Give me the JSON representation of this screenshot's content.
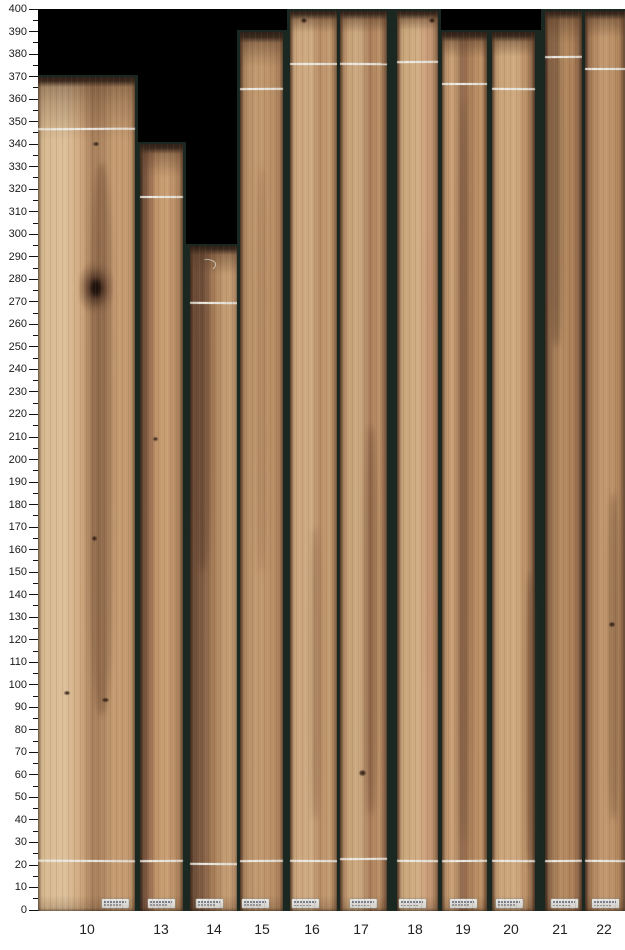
{
  "page": {
    "background": "#ffffff",
    "plot_background": "#000000",
    "gap_color": "#1b2822",
    "chalk_color": "#e9e7df",
    "tick_color": "#111111"
  },
  "chart_data": {
    "type": "bar",
    "title": "",
    "xlabel": "",
    "ylabel": "",
    "categories": [
      "10",
      "13",
      "14",
      "15",
      "16",
      "17",
      "18",
      "19",
      "20",
      "21",
      "22"
    ],
    "values": [
      370,
      340,
      295,
      390,
      400,
      400,
      400,
      390,
      390,
      400,
      400
    ],
    "cropped_at_ymax": [
      "16",
      "17",
      "18",
      "21",
      "22"
    ],
    "top_chalk_lines": [
      347,
      317,
      270,
      365,
      376,
      376,
      377,
      367,
      365,
      379,
      374
    ],
    "bottom_chalk_lines": [
      22,
      22,
      21,
      22,
      22,
      23,
      22,
      22,
      22,
      22,
      22
    ],
    "ylim": [
      0,
      400
    ],
    "y_major_step": 10,
    "y_minor_step": 5,
    "grid": false,
    "legend": false,
    "y_tick_labels": [
      400,
      390,
      380,
      370,
      360,
      350,
      340,
      330,
      320,
      310,
      300,
      290,
      280,
      270,
      260,
      250,
      240,
      230,
      220,
      210,
      200,
      190,
      180,
      170,
      160,
      150,
      140,
      130,
      120,
      110,
      100,
      90,
      80,
      70,
      60,
      50,
      40,
      30,
      20,
      10,
      0
    ]
  },
  "boards": [
    {
      "id": "10",
      "x": 38,
      "w": 97,
      "gl": 0,
      "gr": 3,
      "cx": 87,
      "top": 370,
      "lt": 347,
      "lb": 22,
      "cap": [
        4,
        60
      ],
      "st_x": 64,
      "stops": [
        [
          0,
          "#d8b98f"
        ],
        [
          28,
          "#dcc09a"
        ],
        [
          44,
          "#cfa87e"
        ],
        [
          56,
          "#a8805c"
        ],
        [
          66,
          "#ad8560"
        ],
        [
          78,
          "#c59c72"
        ],
        [
          92,
          "#c49a70"
        ],
        [
          100,
          "#b98f64"
        ]
      ],
      "feats": [
        {
          "t": "streak",
          "vt": 332,
          "vb": 86,
          "xp": 50,
          "wp": 30,
          "c": "rgba(105,70,48,0.42)"
        },
        {
          "t": "knot",
          "v": 276,
          "xp": 60,
          "w": 34,
          "h": 52
        },
        {
          "t": "dot",
          "v": 341,
          "xp": 60,
          "w": 6,
          "h": 4
        },
        {
          "t": "dot",
          "v": 166,
          "xp": 58,
          "w": 5,
          "h": 5
        },
        {
          "t": "dot",
          "v": 97,
          "xp": 30,
          "w": 6,
          "h": 4
        },
        {
          "t": "dot",
          "v": 94,
          "xp": 70,
          "w": 7,
          "h": 4
        }
      ]
    },
    {
      "id": "13",
      "x": 140,
      "w": 43,
      "gl": 3,
      "gr": 3,
      "cx": 161,
      "top": 340,
      "lt": 317,
      "lb": 22,
      "cap": [
        4,
        30
      ],
      "st_x": 8,
      "stops": [
        [
          0,
          "#5f4634"
        ],
        [
          18,
          "#8a6148"
        ],
        [
          38,
          "#c09469"
        ],
        [
          60,
          "#c9a074"
        ],
        [
          85,
          "#b58a62"
        ],
        [
          100,
          "#9c744f"
        ]
      ],
      "feats": [
        {
          "t": "dot",
          "v": 210,
          "xp": 35,
          "w": 5,
          "h": 4
        }
      ]
    },
    {
      "id": "14",
      "x": 190,
      "w": 48,
      "gl": 5,
      "gr": 2,
      "cx": 214,
      "top": 295,
      "lt": 270,
      "lb": 21,
      "cap": [
        3,
        26
      ],
      "st_x": 6,
      "stops": [
        [
          0,
          "#6b4b36"
        ],
        [
          25,
          "#7e5a42"
        ],
        [
          50,
          "#a87e58"
        ],
        [
          75,
          "#c59e74"
        ],
        [
          100,
          "#b9906a"
        ]
      ],
      "feats": [
        {
          "t": "chalkmark",
          "v": 289,
          "xp": 22
        },
        {
          "t": "streak",
          "vt": 295,
          "vb": 150,
          "xp": 6,
          "wp": 40,
          "c": "rgba(80,54,38,0.40)"
        }
      ]
    },
    {
      "id": "15",
      "x": 240,
      "w": 43,
      "gl": 3,
      "gr": 4,
      "cx": 262,
      "top": 390,
      "lt": 365,
      "lb": 22,
      "cap": [
        5,
        30
      ],
      "st_x": 2,
      "stops": [
        [
          0,
          "#8a6448"
        ],
        [
          12,
          "#b08a62"
        ],
        [
          40,
          "#c29a70"
        ],
        [
          70,
          "#bb9168"
        ],
        [
          100,
          "#a87e58"
        ]
      ],
      "feats": [
        {
          "t": "streak",
          "vt": 330,
          "vb": 150,
          "xp": 38,
          "wp": 24,
          "c": "rgba(120,80,55,0.28)"
        }
      ]
    },
    {
      "id": "16",
      "x": 290,
      "w": 47,
      "gl": 3,
      "gr": 3,
      "cx": 312,
      "top": 400,
      "lt": 376,
      "lb": 22,
      "cap": [
        3,
        18
      ],
      "st_x": 2,
      "stops": [
        [
          0,
          "#a87e5a"
        ],
        [
          10,
          "#caa57c"
        ],
        [
          45,
          "#cfab82"
        ],
        [
          62,
          "#b68c64"
        ],
        [
          82,
          "#c49c72"
        ],
        [
          100,
          "#aa8058"
        ]
      ],
      "feats": [
        {
          "t": "streak",
          "vt": 170,
          "vb": 40,
          "xp": 42,
          "wp": 24,
          "c": "rgba(110,75,50,0.32)"
        },
        {
          "t": "dot",
          "v": 396,
          "xp": 30,
          "w": 6,
          "h": 5
        }
      ]
    },
    {
      "id": "17",
      "x": 340,
      "w": 47,
      "gl": 3,
      "gr": 6,
      "cx": 361,
      "top": 400,
      "lt": 376,
      "lb": 23,
      "cap": [
        3,
        18
      ],
      "st_x": 10,
      "stops": [
        [
          0,
          "#9a7050"
        ],
        [
          15,
          "#c49e74"
        ],
        [
          40,
          "#cdab82"
        ],
        [
          64,
          "#a87c58"
        ],
        [
          82,
          "#bb9168"
        ],
        [
          100,
          "#8f6848"
        ]
      ],
      "feats": [
        {
          "t": "streak",
          "vt": 215,
          "vb": 42,
          "xp": 52,
          "wp": 28,
          "c": "rgba(95,62,42,0.40)"
        },
        {
          "t": "dot",
          "v": 62,
          "xp": 48,
          "w": 7,
          "h": 6
        }
      ]
    },
    {
      "id": "18",
      "x": 397,
      "w": 41,
      "gl": 4,
      "gr": 3,
      "cx": 415,
      "top": 400,
      "lt": 377,
      "lb": 22,
      "cap": [
        3,
        16
      ],
      "st_x": 2,
      "stops": [
        [
          0,
          "#8a6248"
        ],
        [
          12,
          "#c8a478"
        ],
        [
          50,
          "#d2ae84"
        ],
        [
          75,
          "#c89c78"
        ],
        [
          100,
          "#b0845e"
        ]
      ],
      "feats": [
        {
          "t": "streak",
          "vt": 300,
          "vb": 100,
          "xp": 68,
          "wp": 24,
          "c": "rgba(190,120,90,0.22)"
        },
        {
          "t": "dot",
          "v": 396,
          "xp": 85,
          "w": 6,
          "h": 5
        }
      ]
    },
    {
      "id": "19",
      "x": 442,
      "w": 45,
      "gl": 3,
      "gr": 3,
      "cx": 463,
      "top": 390,
      "lt": 367,
      "lb": 22,
      "cap": [
        4,
        22
      ],
      "st_x": 8,
      "stops": [
        [
          0,
          "#b88e66"
        ],
        [
          25,
          "#c9a176"
        ],
        [
          46,
          "#8f674a"
        ],
        [
          62,
          "#a87e58"
        ],
        [
          85,
          "#c09468"
        ],
        [
          100,
          "#9c7450"
        ]
      ],
      "feats": [
        {
          "t": "streak",
          "vt": 360,
          "vb": 30,
          "xp": 36,
          "wp": 24,
          "c": "rgba(100,66,45,0.35)"
        }
      ]
    },
    {
      "id": "20",
      "x": 492,
      "w": 43,
      "gl": 3,
      "gr": 6,
      "cx": 511,
      "top": 390,
      "lt": 365,
      "lb": 22,
      "cap": [
        4,
        20
      ],
      "st_x": 4,
      "stops": [
        [
          0,
          "#a87e5a"
        ],
        [
          15,
          "#c8a276"
        ],
        [
          55,
          "#cfaa80"
        ],
        [
          80,
          "#b88e64"
        ],
        [
          100,
          "#7e5a40"
        ]
      ],
      "feats": [
        {
          "t": "streak",
          "vt": 150,
          "vb": 20,
          "xp": 78,
          "wp": 22,
          "c": "rgba(85,56,38,0.45)"
        }
      ]
    },
    {
      "id": "21",
      "x": 545,
      "w": 37,
      "gl": 4,
      "gr": 3,
      "cx": 560,
      "top": 400,
      "lt": 379,
      "lb": 22,
      "cap": [
        3,
        30
      ],
      "st_x": 6,
      "stops": [
        [
          0,
          "#6a4a36"
        ],
        [
          15,
          "#96704e"
        ],
        [
          45,
          "#b68c62"
        ],
        [
          75,
          "#ab8058"
        ],
        [
          100,
          "#7e5a42"
        ]
      ],
      "feats": [
        {
          "t": "streak",
          "vt": 400,
          "vb": 250,
          "xp": 10,
          "wp": 40,
          "c": "rgba(70,46,32,0.40)"
        }
      ]
    },
    {
      "id": "22",
      "x": 585,
      "w": 40,
      "gl": 3,
      "gr": 0,
      "cx": 604,
      "top": 400,
      "lt": 374,
      "lb": 22,
      "cap": [
        3,
        24
      ],
      "st_x": 7,
      "stops": [
        [
          0,
          "#7e5a42"
        ],
        [
          15,
          "#a87e58"
        ],
        [
          45,
          "#c39a70"
        ],
        [
          75,
          "#b88e64"
        ],
        [
          100,
          "#966c4c"
        ]
      ],
      "feats": [
        {
          "t": "streak",
          "vt": 185,
          "vb": 40,
          "xp": 55,
          "wp": 32,
          "c": "rgba(95,62,42,0.40)"
        },
        {
          "t": "dot",
          "v": 128,
          "xp": 68,
          "w": 6,
          "h": 5
        }
      ]
    }
  ]
}
